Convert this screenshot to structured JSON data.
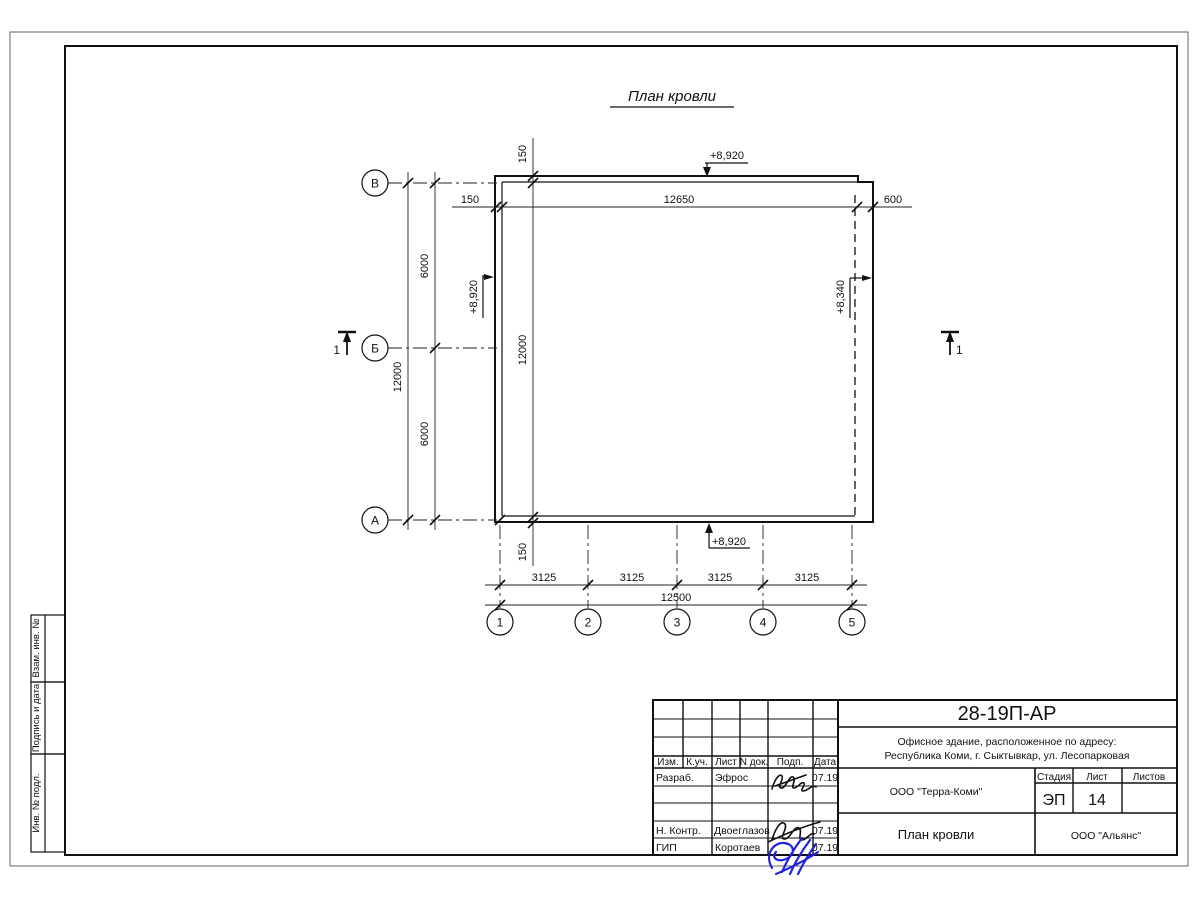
{
  "plan": {
    "title": "План кровли",
    "axes_left": [
      "В",
      "Б",
      "А"
    ],
    "axes_bottom": [
      "1",
      "2",
      "3",
      "4",
      "5"
    ],
    "dims": {
      "top_left_offset": "150",
      "top_span": "12650",
      "top_right_offset": "600",
      "inner_vert_offset_top": "150",
      "inner_vert_total": "12000",
      "inner_vert_offset_bottom": "150",
      "left_segments": [
        "6000",
        "6000"
      ],
      "left_total": "12000",
      "bottom_segments": [
        "3125",
        "3125",
        "3125",
        "3125"
      ],
      "bottom_total": "12500"
    },
    "elevations": {
      "top": "+8,920",
      "left": "+8,920",
      "bottom": "+8,920",
      "right": "+8,340"
    },
    "section_left": "1",
    "section_right": "1"
  },
  "title_block": {
    "doc_code": "28-19П-АР",
    "object_line1": "Офисное здание, расположенное по адресу:",
    "object_line2": "Республика Коми, г. Сыктывкар, ул. Лесопарковая",
    "header_cols": [
      "Изм.",
      "К.уч.",
      "Лист",
      "N док.",
      "Подп.",
      "Дата"
    ],
    "rows": [
      {
        "role": "Разраб.",
        "name": "Эфрос",
        "date": "07.19"
      },
      {
        "role": "Н. Контр.",
        "name": "Двоеглазов",
        "date": "07.19"
      },
      {
        "role": "ГИП",
        "name": "Коротаев",
        "date": "07.19"
      }
    ],
    "org_middle": "ООО \"Терра-Коми\"",
    "sheet_title": "План кровли",
    "org_right": "ООО \"Альянс\"",
    "stage_label": "Стадия",
    "sheet_label": "Лист",
    "sheets_label": "Листов",
    "stage_value": "ЭП",
    "sheet_value": "14",
    "sheets_value": ""
  },
  "side_labels": [
    "Взам. инв. №",
    "Подпись и дата",
    "Инв. № подл."
  ]
}
